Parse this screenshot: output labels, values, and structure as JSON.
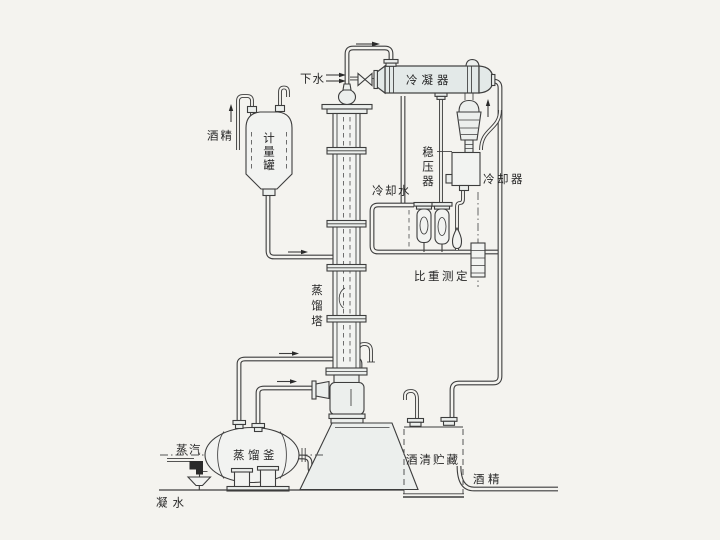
{
  "diagram": {
    "background": "#f4f3ef",
    "line_color": "#3d3d3d",
    "labels": {
      "drain_water": "下水",
      "condenser": "冷凝器",
      "alcohol_feed": "酒精",
      "measuring_tank": "计量罐",
      "pressure_stabilizer": "稳压器",
      "cooling_water": "冷却水",
      "cooler": "冷却器",
      "gravity_measurement": "比重测定",
      "distillation_column": "蒸馏塔",
      "distillation_kettle": "蒸馏釜",
      "steam": "蒸汽",
      "alcohol_storage": "酒清贮藏",
      "alcohol_out": "酒精",
      "condensate": "凝水"
    }
  }
}
